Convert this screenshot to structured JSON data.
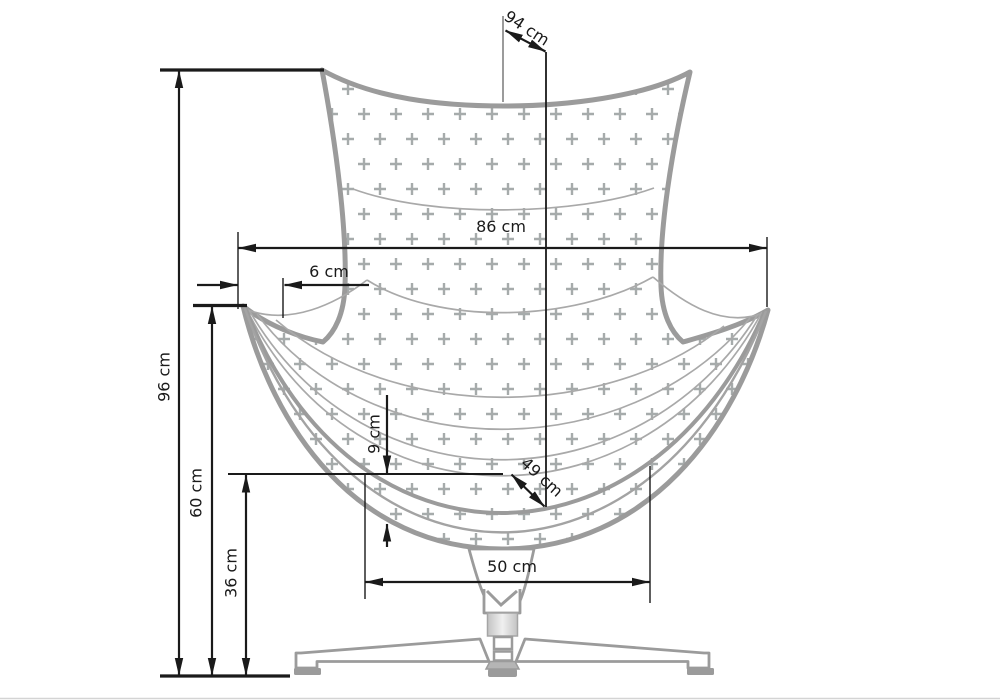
{
  "diagram": {
    "units": "cm",
    "labels": {
      "top_depth": "94 cm",
      "overall_width": "86 cm",
      "arm_inset": "6 cm",
      "overall_height": "96 cm",
      "armrest_height": "60 cm",
      "seat_height": "36 cm",
      "cushion_thickness": "9 cm",
      "seat_depth": "49 cm",
      "base_width": "50 cm"
    },
    "colors": {
      "outline_gray": "#9b9b9b",
      "seam_gray": "#a9a9a9",
      "pattern_plus_gray": "#a6abab",
      "dimension_black": "#1a1a1a",
      "background": "#ffffff",
      "gaslift_fill": "#d9d9d9"
    }
  }
}
